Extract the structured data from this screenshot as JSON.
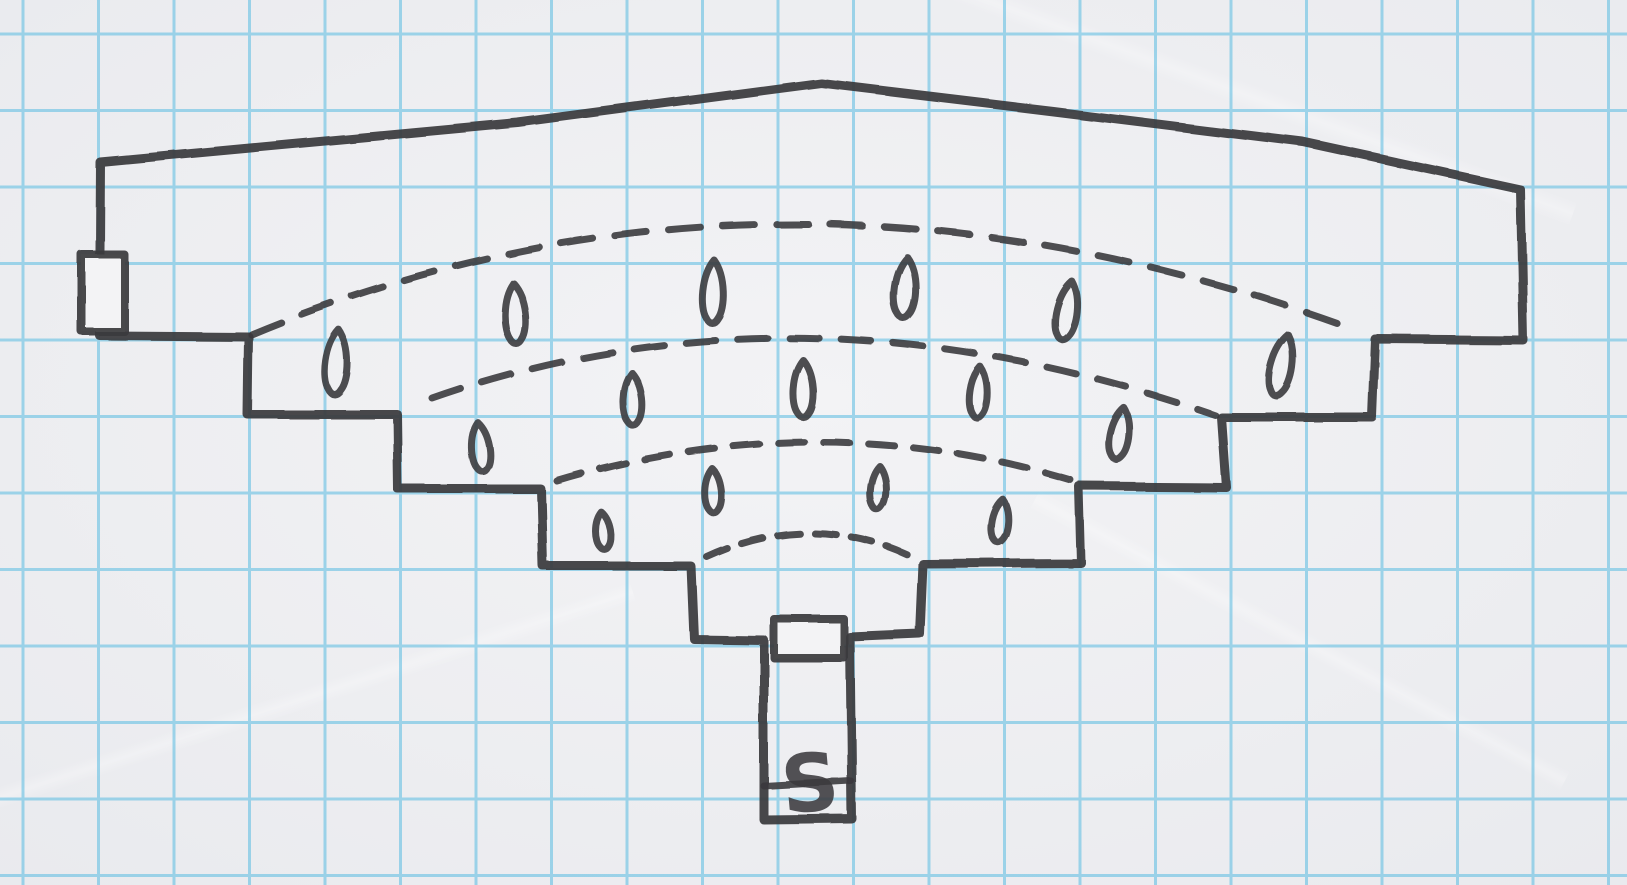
{
  "scene": {
    "description": "Hand-drawn fan-shaped amphitheater dungeon map sketched in dark marker on blue graph paper",
    "canvas": {
      "width": 1627,
      "height": 885
    }
  },
  "paper": {
    "color_center": "#f3f3f5",
    "color_edge": "#e9eaee",
    "grid": {
      "color": "#59bce2",
      "spacing_x": 75.5,
      "spacing_y": 76.5,
      "offset_x": 23,
      "offset_y": 34,
      "line_width": 3,
      "opacity": 0.55
    }
  },
  "ink": {
    "color": "#3b3a3d",
    "wall_width": 9,
    "arc_width": 7,
    "mark_width": 7,
    "door_width": 8
  },
  "walls": {
    "outer_outline": [
      [
        100,
        162
      ],
      [
        518,
        123
      ],
      [
        821,
        83
      ],
      [
        1053,
        111
      ],
      [
        1303,
        142
      ],
      [
        1520,
        189
      ],
      [
        1523,
        340
      ],
      [
        1375,
        339
      ],
      [
        1372,
        417
      ],
      [
        1221,
        417
      ],
      [
        1226,
        487
      ],
      [
        1079,
        486
      ],
      [
        1081,
        563
      ],
      [
        923,
        564
      ],
      [
        920,
        634
      ],
      [
        850,
        637
      ],
      [
        852,
        819
      ],
      [
        764,
        820
      ],
      [
        764,
        640
      ],
      [
        694,
        639
      ],
      [
        691,
        566
      ],
      [
        543,
        566
      ],
      [
        541,
        489
      ],
      [
        398,
        489
      ],
      [
        397,
        414
      ],
      [
        247,
        414
      ],
      [
        248,
        336
      ],
      [
        99,
        335
      ]
    ]
  },
  "doors": [
    {
      "name": "west-door",
      "x": 81,
      "y": 254,
      "width": 43,
      "height": 77
    },
    {
      "name": "south-door",
      "x": 774,
      "y": 619,
      "width": 70,
      "height": 39
    }
  ],
  "tier_arcs": [
    {
      "name": "tier-1",
      "start": [
        251,
        334
      ],
      "apex": [
        790,
        224
      ],
      "end": [
        1356,
        330
      ],
      "dash": "32 22"
    },
    {
      "name": "tier-2",
      "start": [
        432,
        398
      ],
      "apex": [
        810,
        338
      ],
      "end": [
        1215,
        415
      ],
      "dash": "30 22"
    },
    {
      "name": "tier-3",
      "start": [
        557,
        481
      ],
      "apex": [
        818,
        442
      ],
      "end": [
        1074,
        481
      ],
      "dash": "26 19"
    },
    {
      "name": "tier-4",
      "start": [
        707,
        557
      ],
      "apex": [
        810,
        533
      ],
      "end": [
        912,
        557
      ],
      "dash": "22 15"
    }
  ],
  "seat_marks": [
    {
      "x": 337,
      "y": 363,
      "w": 28,
      "h": 66,
      "rot": 4
    },
    {
      "x": 515,
      "y": 314,
      "w": 26,
      "h": 62,
      "rot": -3
    },
    {
      "x": 713,
      "y": 292,
      "w": 26,
      "h": 64,
      "rot": 2
    },
    {
      "x": 905,
      "y": 288,
      "w": 27,
      "h": 62,
      "rot": 4
    },
    {
      "x": 1067,
      "y": 311,
      "w": 26,
      "h": 60,
      "rot": 10
    },
    {
      "x": 1282,
      "y": 366,
      "w": 27,
      "h": 63,
      "rot": 12
    },
    {
      "x": 480,
      "y": 447,
      "w": 23,
      "h": 50,
      "rot": -6
    },
    {
      "x": 633,
      "y": 400,
      "w": 24,
      "h": 54,
      "rot": -2
    },
    {
      "x": 803,
      "y": 389,
      "w": 25,
      "h": 58,
      "rot": 0
    },
    {
      "x": 978,
      "y": 392,
      "w": 22,
      "h": 52,
      "rot": 4
    },
    {
      "x": 1120,
      "y": 434,
      "w": 24,
      "h": 53,
      "rot": 9
    },
    {
      "x": 603,
      "y": 531,
      "w": 19,
      "h": 38,
      "rot": -5
    },
    {
      "x": 713,
      "y": 491,
      "w": 21,
      "h": 45,
      "rot": -2
    },
    {
      "x": 878,
      "y": 488,
      "w": 20,
      "h": 45,
      "rot": 3
    },
    {
      "x": 1000,
      "y": 521,
      "w": 21,
      "h": 44,
      "rot": 7
    }
  ],
  "stairs": {
    "label": "S",
    "x": 810,
    "y": 811,
    "font_size": 80,
    "rotation": -5,
    "step_line": {
      "x1": 764,
      "y1": 786,
      "x2": 851,
      "y2": 781
    }
  }
}
